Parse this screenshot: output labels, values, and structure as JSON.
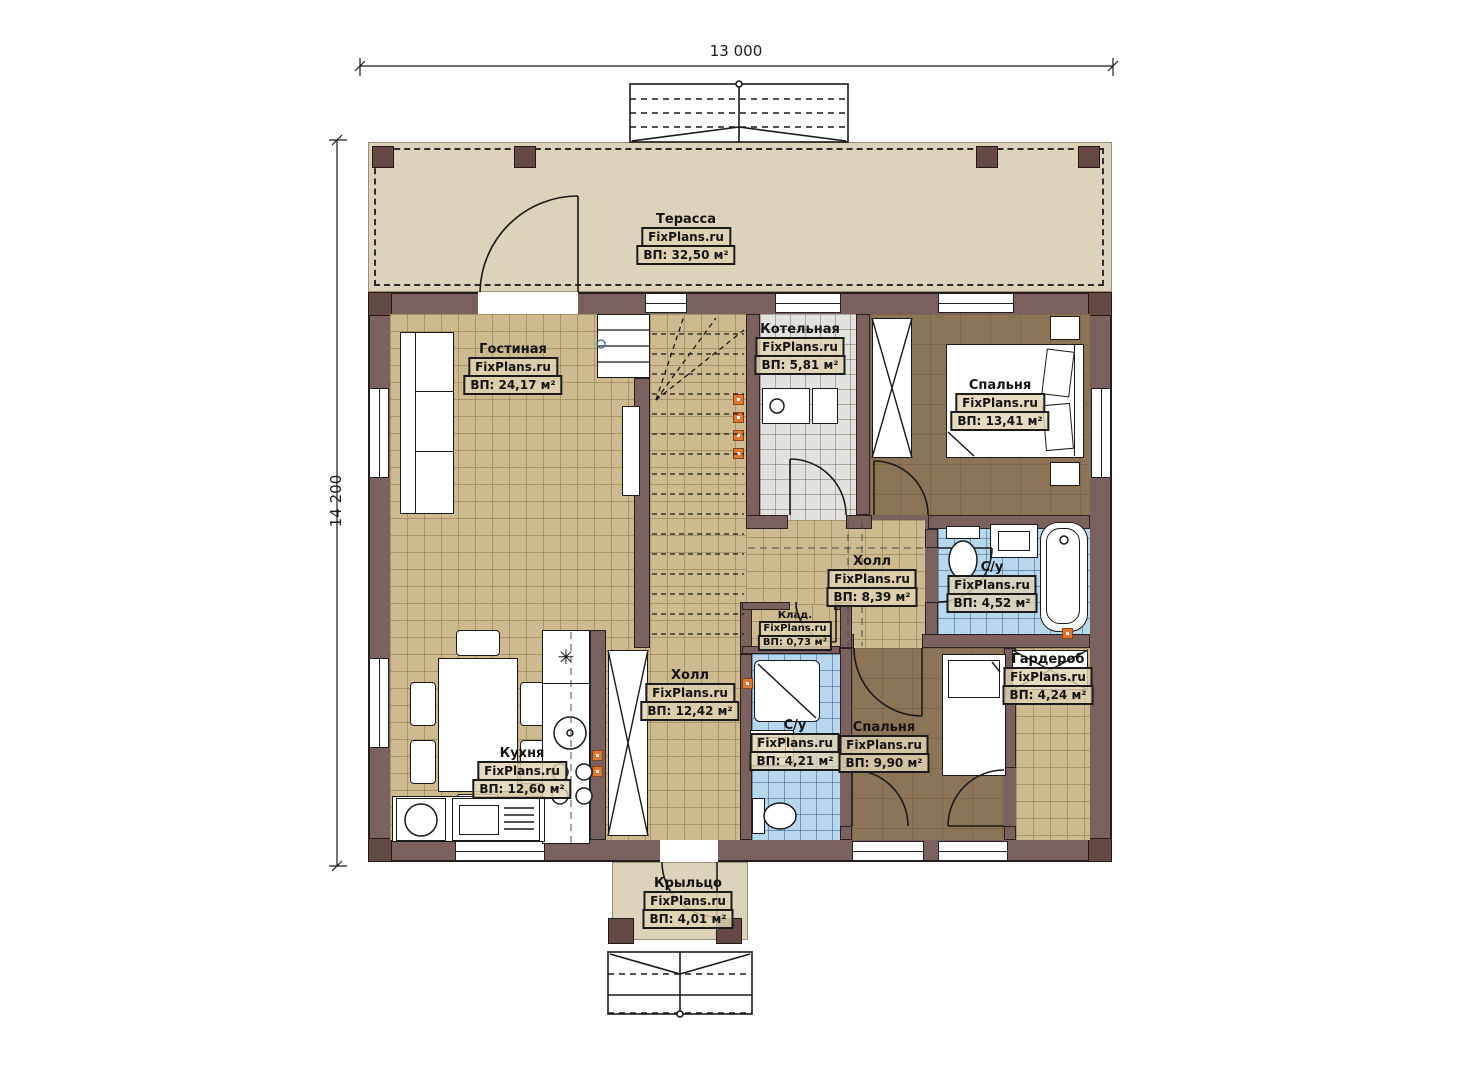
{
  "plan": {
    "watermark": "FixPlans.ru",
    "dimensions": {
      "width": "13 000",
      "height": "14 200"
    },
    "rooms": [
      {
        "name": "Терасса",
        "area": "ВП: 32,50 м²"
      },
      {
        "name": "Гостиная",
        "area": "ВП: 24,17 м²"
      },
      {
        "name": "Котельная",
        "area": "ВП: 5,81 м²"
      },
      {
        "name": "Спальня",
        "area": "ВП: 13,41 м²"
      },
      {
        "name": "Холл",
        "area": "ВП: 8,39 м²"
      },
      {
        "name": "С/у",
        "area": "ВП: 4,52 м²"
      },
      {
        "name": "Клад.",
        "area": "ВП: 0,73 м²"
      },
      {
        "name": "Холл",
        "area": "ВП: 12,42 м²"
      },
      {
        "name": "С/у",
        "area": "ВП: 4,21 м²"
      },
      {
        "name": "Спальня",
        "area": "ВП: 9,90 м²"
      },
      {
        "name": "Гардероб",
        "area": "ВП: 4,24 м²"
      },
      {
        "name": "Кухня",
        "area": "ВП: 12,60 м²"
      },
      {
        "name": "Крыльцо",
        "area": "ВП: 4,01 м²"
      }
    ],
    "icons": {
      "fridge": "✳"
    },
    "colors": {
      "wall": "#7a615e",
      "floor_tan": "#cdbb8f",
      "floor_brown": "#8c7456",
      "floor_blue": "#b7d7ec",
      "floor_gray": "#e3e2df",
      "terrace": "#ddd2ba",
      "marker": "#e0762f"
    }
  }
}
